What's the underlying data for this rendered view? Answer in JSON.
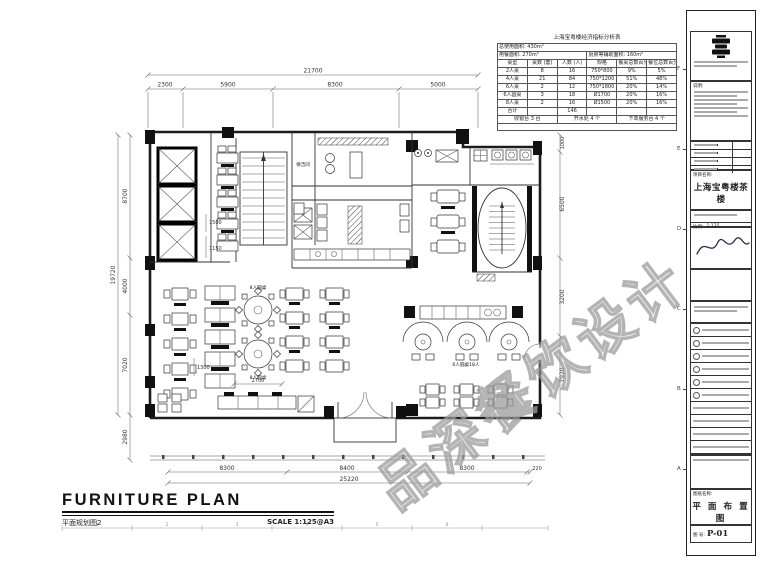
{
  "watermark": "品深餐饮设计",
  "econ_table": {
    "title": "上海宝粤楼经济指标分析表",
    "area_row1": "总使用面积: 430m²",
    "area_row2a": "用餐面积: 270m²",
    "area_row2b": "厨房等辅助面积: 160m²",
    "headers": [
      "桌型",
      "桌数 (套)",
      "人数 (人)",
      "规格",
      "餐桌总数百分比",
      "餐位总数百分比"
    ],
    "rows": [
      [
        "2人桌",
        "8",
        "16",
        "750*800",
        "9%",
        "5%"
      ],
      [
        "4人桌",
        "21",
        "84",
        "750*1200",
        "51%",
        "48%"
      ],
      [
        "6人桌",
        "2",
        "12",
        "750*1800",
        "20%",
        "14%"
      ],
      [
        "6人圆桌",
        "3",
        "18",
        "Ø1700",
        "20%",
        "16%"
      ],
      [
        "8人桌",
        "2",
        "16",
        "Ø1500",
        "20%",
        "16%"
      ]
    ],
    "total_label": "合计",
    "total_people": "146",
    "footer_cells": [
      "收银台 3 台",
      "开水处 4 个",
      "下单服务台 4 个"
    ]
  },
  "dims": {
    "top": {
      "total": "21700",
      "parts": [
        "2300",
        "5900",
        "8300",
        "5000"
      ]
    },
    "bottom": {
      "total": "25220",
      "parts": [
        "8300",
        "8400",
        "8300",
        "220"
      ]
    },
    "left": {
      "total": "19720",
      "parts": [
        "8700",
        "4000",
        "7020",
        "2980"
      ]
    },
    "right": {
      "parts": [
        "1000",
        "6500",
        "3200",
        "7920"
      ]
    },
    "inner": {
      "a": "1500",
      "b": "1150",
      "c": "1300",
      "d": "2700"
    }
  },
  "plan_labels": {
    "round_a": "8人圆桌",
    "round_b": "8人圆桌",
    "cleaning": "保洁间",
    "booth6": "6人圆桌18人"
  },
  "ruler_numbers": [
    "1",
    "2",
    "3",
    "4",
    "5",
    "6"
  ],
  "titleblock": {
    "zones": [
      "F",
      "E",
      "D",
      "C",
      "B",
      "A"
    ],
    "notes_label": "说明:",
    "project_label": "项目名称:",
    "project_name": "上海宝粤楼茶楼",
    "scale_label": "比例:",
    "scale_value": "1:125",
    "drawing_label": "图纸名称:",
    "drawing_name": "平 面 布 置 图",
    "number_label": "图 号:",
    "number_value": "P-01"
  },
  "footer": {
    "title": "FURNITURE PLAN",
    "subtitle_cn": "平面规划图2",
    "scale_text": "SCALE  1:125@A3"
  }
}
